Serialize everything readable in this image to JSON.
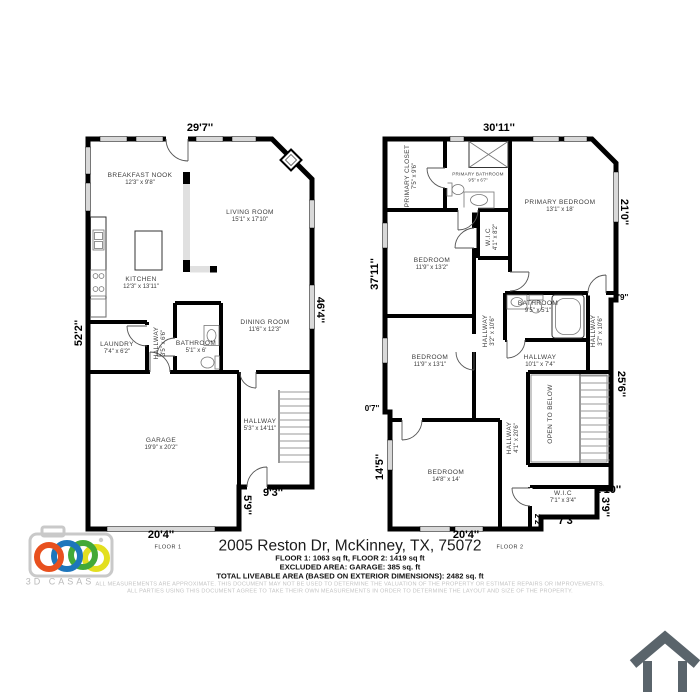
{
  "floor1": {
    "caption": "FLOOR 1",
    "rooms": {
      "breakfast_nook": {
        "name": "BREAKFAST NOOK",
        "size": "12'3\" x 9'8\""
      },
      "living_room": {
        "name": "LIVING ROOM",
        "size": "15'1\" x 17'10\""
      },
      "kitchen": {
        "name": "KITCHEN",
        "size": "12'3\" x 13'11\""
      },
      "laundry": {
        "name": "LAUNDRY",
        "size": "7'4\" x 6'2\""
      },
      "hallway_small": {
        "name": "HALLWAY",
        "size": "3'5\" x 6'6\""
      },
      "bathroom": {
        "name": "BATHROOM",
        "size": "5'1\" x 6'"
      },
      "dining_room": {
        "name": "DINING ROOM",
        "size": "11'6\" x 12'3\""
      },
      "garage": {
        "name": "GARAGE",
        "size": "19'9\" x 20'2\""
      },
      "hallway": {
        "name": "HALLWAY",
        "size": "5'3\" x 14'11\""
      }
    },
    "dimensions": {
      "top": "29'7''",
      "left": "52'2''",
      "right": "46'4''",
      "bottom": "20'4''",
      "hall_bottom": "9'3''",
      "step": "5'9''"
    }
  },
  "floor2": {
    "caption": "FLOOR 2",
    "rooms": {
      "primary_closet": {
        "name": "PRIMARY CLOSET",
        "size": "7'5\" x 9'6\""
      },
      "primary_bathroom": {
        "name": "PRIMARY BATHROOM",
        "size": "9'5\" x 6'7\""
      },
      "primary_bedroom": {
        "name": "PRIMARY BEDROOM",
        "size": "13'1\" x 18'"
      },
      "wic_top": {
        "name": "W.I.C",
        "size": "4'1\" x 8'2\""
      },
      "bedroom_top": {
        "name": "BEDROOM",
        "size": "11'9\" x 13'2\""
      },
      "bedroom_mid": {
        "name": "BEDROOM",
        "size": "11'9\" x 13'1\""
      },
      "bathroom": {
        "name": "BATHROOM",
        "size": "9'5\" x 5'1\""
      },
      "hallway_left": {
        "name": "HALLWAY",
        "size": "3'2\" x 10'6\""
      },
      "hallway_right": {
        "name": "HALLWAY",
        "size": "3'7\" x 10'6\""
      },
      "hallway_center": {
        "name": "HALLWAY",
        "size": "10'1\" x 7'4\""
      },
      "hallway_lower": {
        "name": "HALLWAY",
        "size": "4'1\" x 20'6\""
      },
      "open_to_below": {
        "name": "OPEN TO BELOW"
      },
      "bedroom_bottom": {
        "name": "BEDROOM",
        "size": "14'8\" x 14'"
      },
      "wic_bottom": {
        "name": "W.I.C",
        "size": "7'1\" x 3'4\""
      }
    },
    "dimensions": {
      "top": "30'11''",
      "left": "37'11''",
      "left_jog": "0'7''",
      "left_bottom": "14'5''",
      "right_top": "21'0''",
      "right_jog": "0'9''",
      "right_mid": "25'6''",
      "wic_width": "1'10''",
      "wic_height": "3'9''",
      "wic_bottom": "7'3''",
      "step": "2'2''",
      "bottom": "20'4''"
    }
  },
  "footer": {
    "address": "2005 Reston Dr, McKinney, TX, 75072",
    "area_line1": "FLOOR 1: 1063 sq ft, FLOOR 2: 1419 sq ft",
    "area_line2": "EXCLUDED AREA: GARAGE: 385 sq. ft",
    "area_line3": "TOTAL LIVEABLE AREA (BASED ON EXTERIOR DIMENSIONS): 2482 sq. ft",
    "disclaimer_line1": "ALL MEASUREMENTS ARE APPROXIMATE. THIS DOCUMENT MAY NOT BE USED TO DETERMINE THE VALUATION OF THE PROPERTY OR ESTIMATE REPAIRS OR IMPROVEMENTS.",
    "disclaimer_line2": "ALL PARTIES USING THIS DOCUMENT AGREE TO TAKE THEIR OWN MEASUREMENTS IN ORDER TO DETERMINE THE LAYOUT AND SIZE OF THE PROPERTY."
  },
  "branding": {
    "logo_text": "3D CASAS",
    "icons": {
      "logo": "camera-rings-icon",
      "corner": "house-outline-icon"
    },
    "colors": {
      "wall": "#000000",
      "window": "#d9d9d9",
      "logo_red": "#e8501e",
      "logo_blue": "#1d76bc",
      "logo_green": "#43a938",
      "logo_yellow": "#e3df1f",
      "logo_gray": "#c9c9c9",
      "house_icon": "#5a646b"
    }
  }
}
